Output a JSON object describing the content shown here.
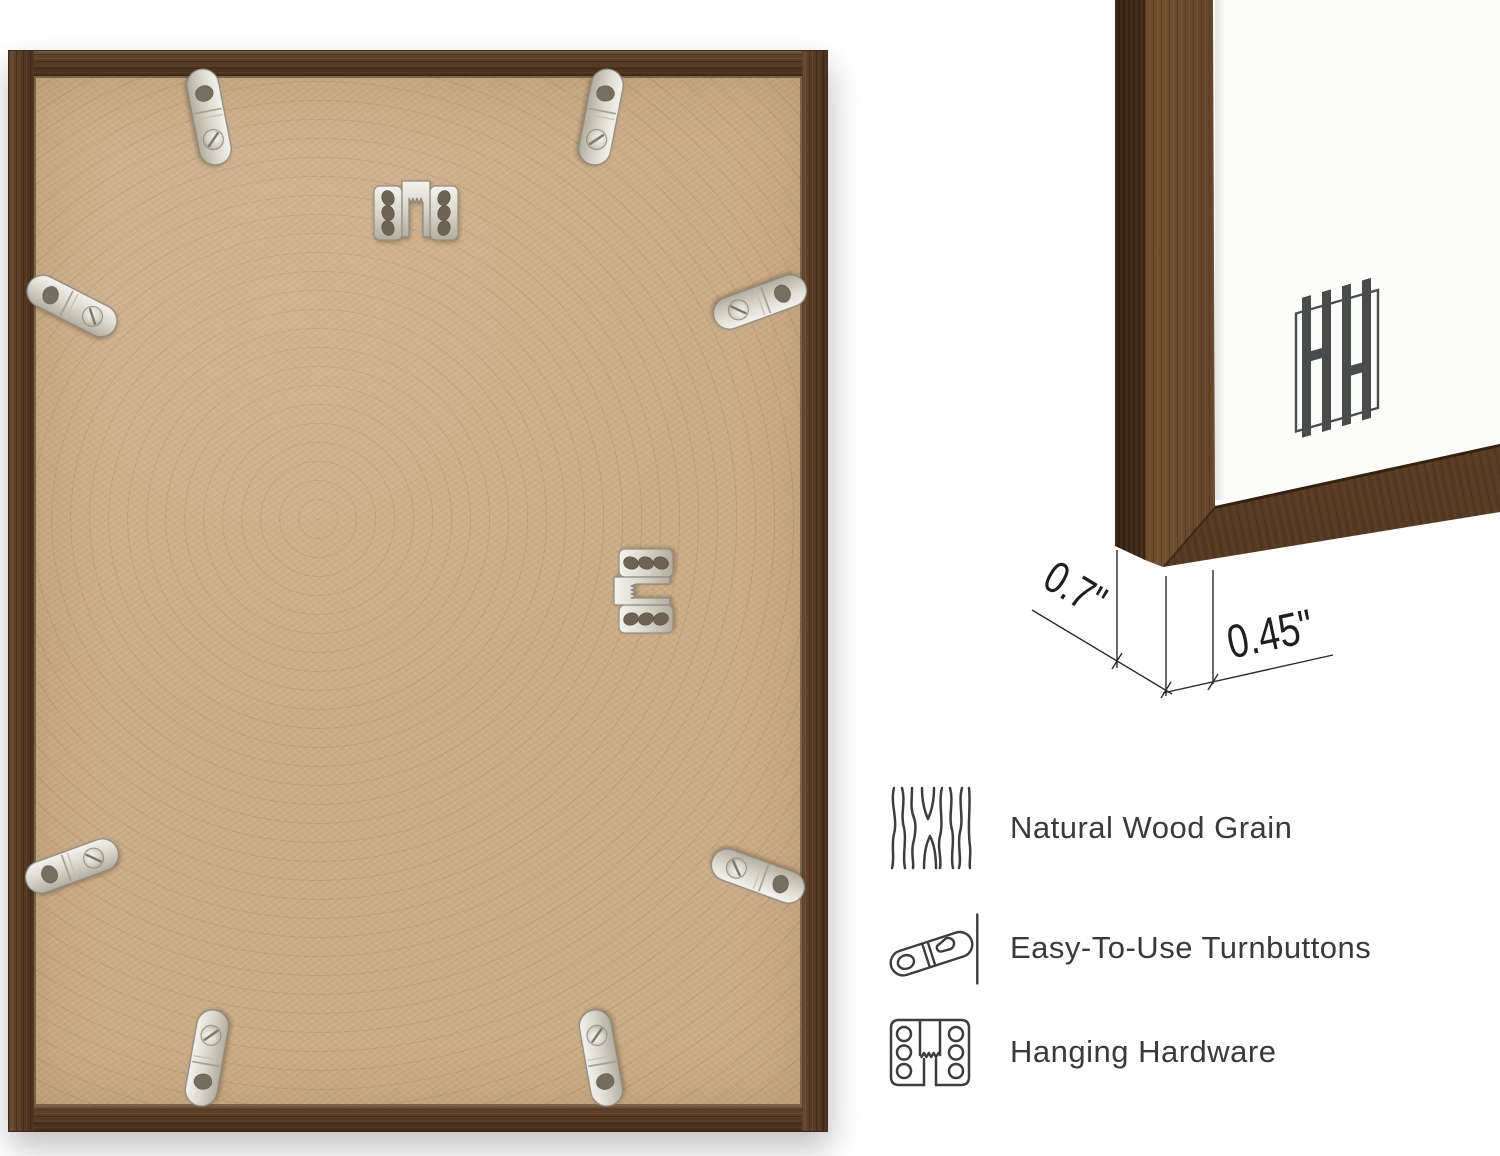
{
  "annotations": {
    "depth_dimension": "0.7\"",
    "face_width_dimension": "0.45\""
  },
  "features": [
    {
      "icon": "wood-grain-icon",
      "label": "Natural Wood Grain"
    },
    {
      "icon": "turnbutton-icon",
      "label": "Easy-To-Use Turnbuttons"
    },
    {
      "icon": "hanging-hardware-icon",
      "label": "Hanging Hardware"
    }
  ],
  "logo": {
    "monogram": "HH"
  },
  "hardware": {
    "turnbutton_count": 8,
    "sawtooth_hanger_count": 2
  },
  "colors": {
    "background": "#ffffff",
    "wood": "#5e3f27",
    "wood_dark": "#46301b",
    "mdf_board": "#ccad89",
    "metal": "#d9d6cd",
    "annotation_line": "#2b2b2b",
    "feature_text": "#3a3a3a",
    "logo_gray": "#4a4b4d",
    "matte": "#fcfcfb"
  }
}
